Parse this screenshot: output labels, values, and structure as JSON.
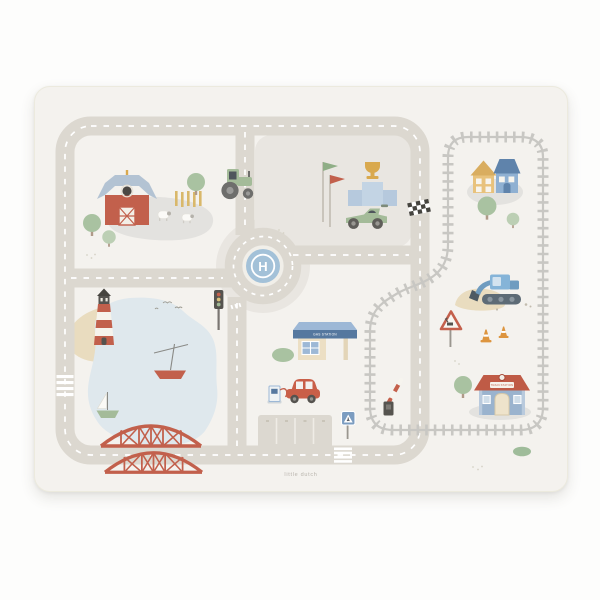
{
  "product": {
    "description": "Little Dutch children road playmat, top view on white background"
  },
  "mat": {
    "helipad_letter": "H",
    "gas_station_sign": "GAS STATION",
    "train_station_sign": "TRAIN STATION",
    "brand_watermark": "little dutch"
  },
  "scene_elements": [
    "red-barn",
    "farm-fence",
    "sheep",
    "tractor",
    "farm-trees",
    "racing-flags",
    "winners-podium",
    "trophy",
    "race-car",
    "checkered-finish-line",
    "roundabout",
    "helipad",
    "traffic-light",
    "zebra-crossings",
    "lighthouse",
    "beach",
    "lake",
    "red-sailboat",
    "green-sailboat",
    "red-truss-bridge",
    "gas-station",
    "fuel-pump",
    "red-car",
    "bush",
    "parking-lot",
    "pedestrian-sign",
    "train-track-loop",
    "railroad-crossing-barrier",
    "yellow-house",
    "blue-house",
    "excavator",
    "sand-pile",
    "traffic-cones",
    "warning-sign",
    "train-station",
    "station-tree",
    "bushes",
    "birds",
    "speckles"
  ],
  "colors": {
    "page_bg": "#fdfdfc",
    "mat_bg": "#f4f2ee",
    "road": "#dcd8d0",
    "road_dash": "#ffffff",
    "block_gray": "#e9e6e1",
    "track_gray": "#c8c7c3",
    "water_blue": "#dfe8ed",
    "sand": "#e9dcbf",
    "meadow_gray": "#e3e2df",
    "accent_red": "#c2604c",
    "leaf_green": "#a9c2a1",
    "leaf_green_light": "#bccfb4",
    "vehicle_green": "#a4bb99",
    "sky_blue": "#9db8d6",
    "steel_blue": "#55789f",
    "house_yellow": "#e8c27c",
    "roof_yellow": "#d9ad5f",
    "trophy_gold": "#d9a94e",
    "cone_orange": "#dd953f",
    "dark_gray": "#55534f",
    "helipad_blue": "#a3c1d8",
    "excavator_blue": "#85b4d8",
    "station_blue": "#9ab3ce",
    "cream": "#ecdfc4",
    "trunk_brown": "#b09a88",
    "text_gray": "#b8b4ac"
  }
}
